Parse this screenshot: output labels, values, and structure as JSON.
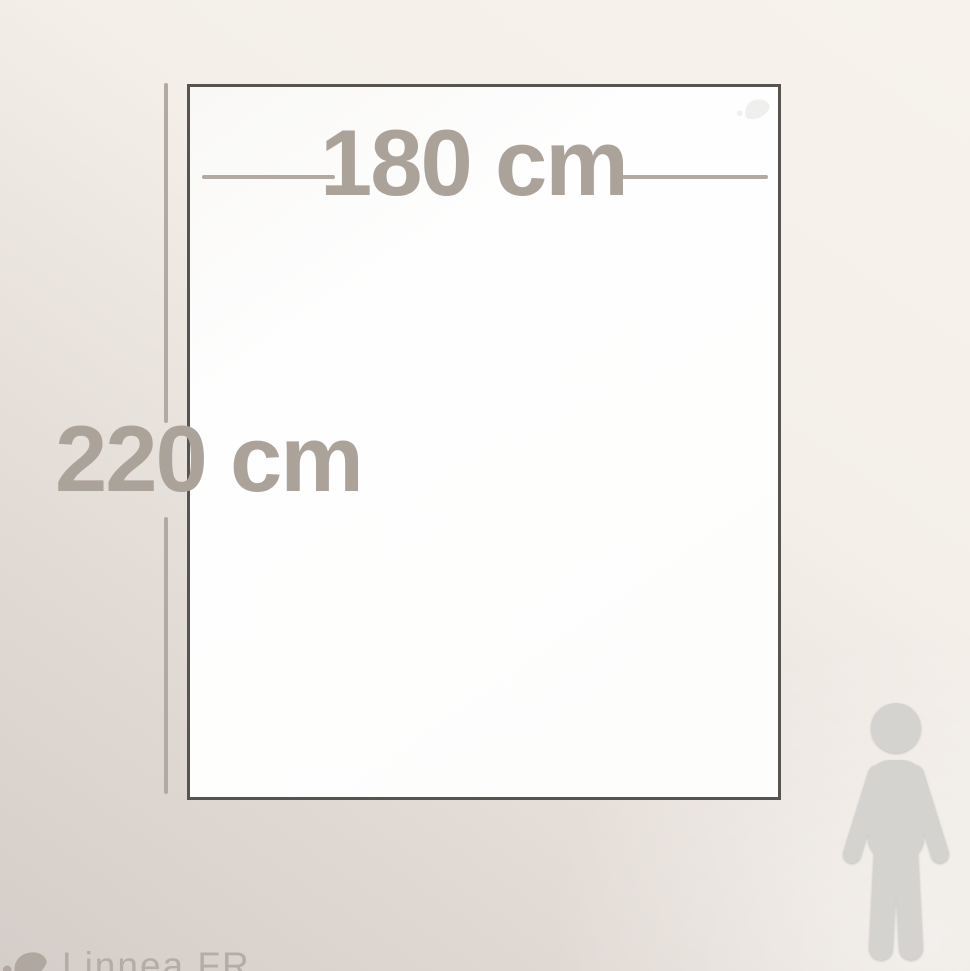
{
  "diagram": {
    "description_labels": {
      "width_label": "180 cm",
      "height_label": "220 cm"
    },
    "width_cm": 180,
    "height_cm": 220
  },
  "brand": {
    "watermark": "Linnea.FR"
  },
  "icons": {
    "person": "person-silhouette-icon",
    "watermark_leaf": "leaf-icon",
    "corner_leaf": "leaf-icon-faint"
  },
  "colors": {
    "label_text": "#aba29a",
    "dimension_line": "#b1a9a2",
    "outline": "#57544f",
    "sheet_fill": "#fefefe",
    "figure_fill": "#d4d3cf",
    "background_top": "#f7f3ec",
    "background_bottom": "#d4cdc8",
    "watermark_text": "#b5aca6"
  }
}
